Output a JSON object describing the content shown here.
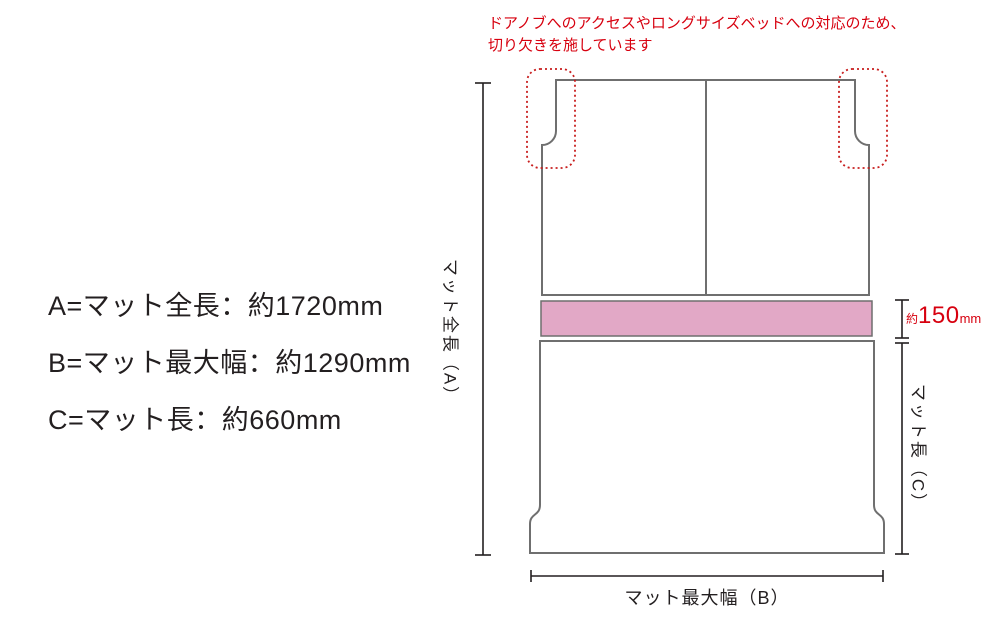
{
  "annotation": {
    "line1": "ドアノブへのアクセスやロングサイズベッドへの対応のため、",
    "line2": "切り欠きを施しています"
  },
  "legend": {
    "items": [
      {
        "label": "A=マット全長：約1720mm"
      },
      {
        "label": "B=マット最大幅：約1290mm"
      },
      {
        "label": "C=マット長：約660mm"
      }
    ]
  },
  "diagram": {
    "label_total_length": "マット全長（A）",
    "label_max_width": "マット最大幅（B）",
    "label_mat_length": "マット長（C）",
    "gap_dimension": {
      "prefix": "約",
      "value": "150",
      "unit": "mm"
    }
  },
  "colors": {
    "accent_red": "#d7000f",
    "pink_band_fill": "#e2a8c6",
    "mat_outline": "#6f6f6f",
    "dimension_line": "#231f20"
  }
}
